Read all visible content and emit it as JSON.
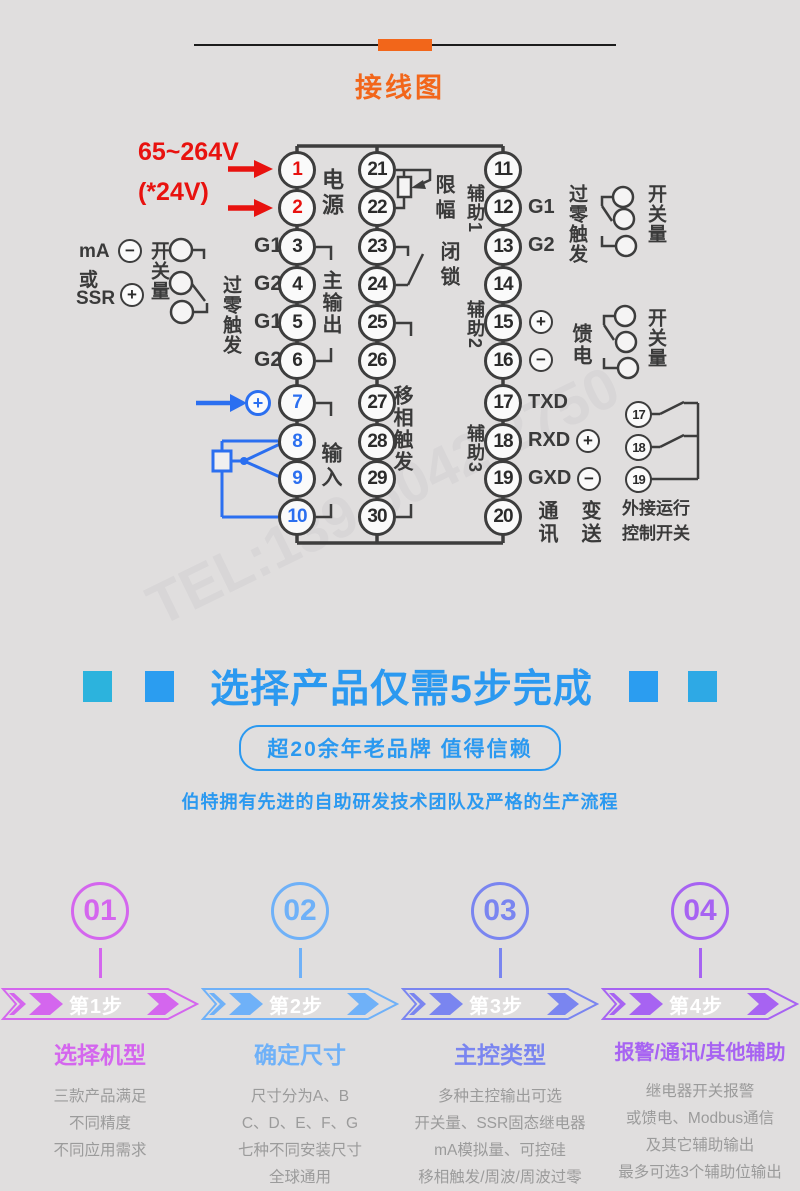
{
  "header": {
    "title": "接线图",
    "accent_color": "#f2661a"
  },
  "watermark": "TEL:139 6042 2750",
  "diagram": {
    "left_col": [
      "1",
      "2",
      "3",
      "4",
      "5",
      "6",
      "7",
      "8",
      "9",
      "10"
    ],
    "mid_col": [
      "21",
      "22",
      "23",
      "24",
      "25",
      "26",
      "27",
      "28",
      "29",
      "30"
    ],
    "right_col": [
      "11",
      "12",
      "13",
      "14",
      "15",
      "16",
      "17",
      "18",
      "19",
      "20"
    ],
    "ext_col": [
      "17",
      "18",
      "19"
    ],
    "labels": {
      "voltage_main": "65~264V",
      "voltage_alt": "(*24V)",
      "power": "电源",
      "g1": "G1",
      "g2": "G2",
      "main_output": "主输出",
      "zero_cross": "过零触发",
      "switch_qty": "开关量",
      "ma": "mA",
      "or": "或",
      "ssr": "SSR",
      "input": "输入",
      "limit": "限幅",
      "latch": "闭锁",
      "phase_shift": "移相触发",
      "aux1": "辅助1",
      "aux2": "辅助2",
      "aux3": "辅助3",
      "feed": "馈电",
      "txd": "TXD",
      "rxd": "RXD",
      "gxd": "GXD",
      "comm": "通讯",
      "transmit": "变送",
      "ext_switch_line1": "外接运行",
      "ext_switch_line2": "控制开关",
      "plus": "+",
      "minus": "−"
    },
    "wire_colors": {
      "default": "#3d3d3d",
      "power_red": "#e8120f",
      "input_blue": "#2b6ff0"
    }
  },
  "promo": {
    "title": "选择产品仅需5步完成",
    "badge": "超20余年老品牌 值得信赖",
    "subtitle": "伯特拥有先进的自助研发技术团队及严格的生产流程",
    "accent": "#2b99f0"
  },
  "steps": [
    {
      "num": "01",
      "banner": "第1步",
      "title": "选择机型",
      "color": "#d466ee",
      "desc": [
        "三款产品满足",
        "不同精度",
        "不同应用需求"
      ]
    },
    {
      "num": "02",
      "banner": "第2步",
      "title": "确定尺寸",
      "color": "#6fb1f8",
      "desc": [
        "尺寸分为A、B",
        "C、D、E、F、G",
        "七种不同安装尺寸",
        "全球通用"
      ]
    },
    {
      "num": "03",
      "banner": "第3步",
      "title": "主控类型",
      "color": "#7a85f0",
      "desc": [
        "多种主控输出可选",
        "开关量、SSR固态继电器",
        "mA模拟量、可控硅",
        "移相触发/周波/周波过零"
      ]
    },
    {
      "num": "04",
      "banner": "第4步",
      "title": "报警/通讯/其他辅助",
      "color": "#a763f2",
      "desc": [
        "继电器开关报警",
        "或馈电、Modbus通信",
        "及其它辅助输出",
        "最多可选3个辅助位输出"
      ]
    }
  ]
}
